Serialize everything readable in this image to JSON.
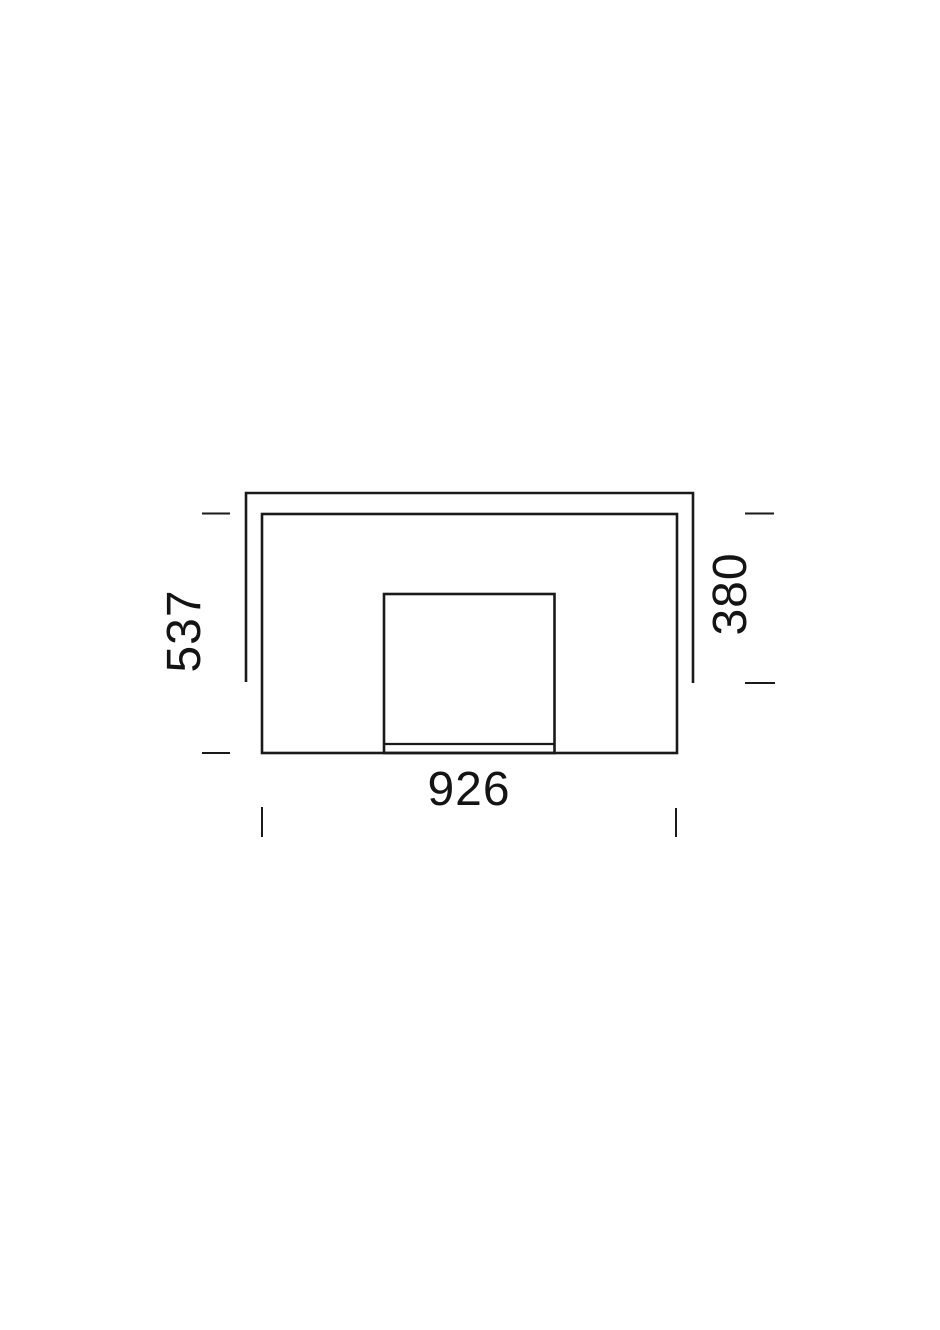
{
  "diagram": {
    "kind": "technical-dimension-drawing",
    "labels": {
      "left_height": "537",
      "right_height": "380",
      "bottom_width": "926"
    },
    "colors": {
      "background": "#ffffff",
      "line": "#1a1a1a",
      "text": "#141414"
    }
  }
}
